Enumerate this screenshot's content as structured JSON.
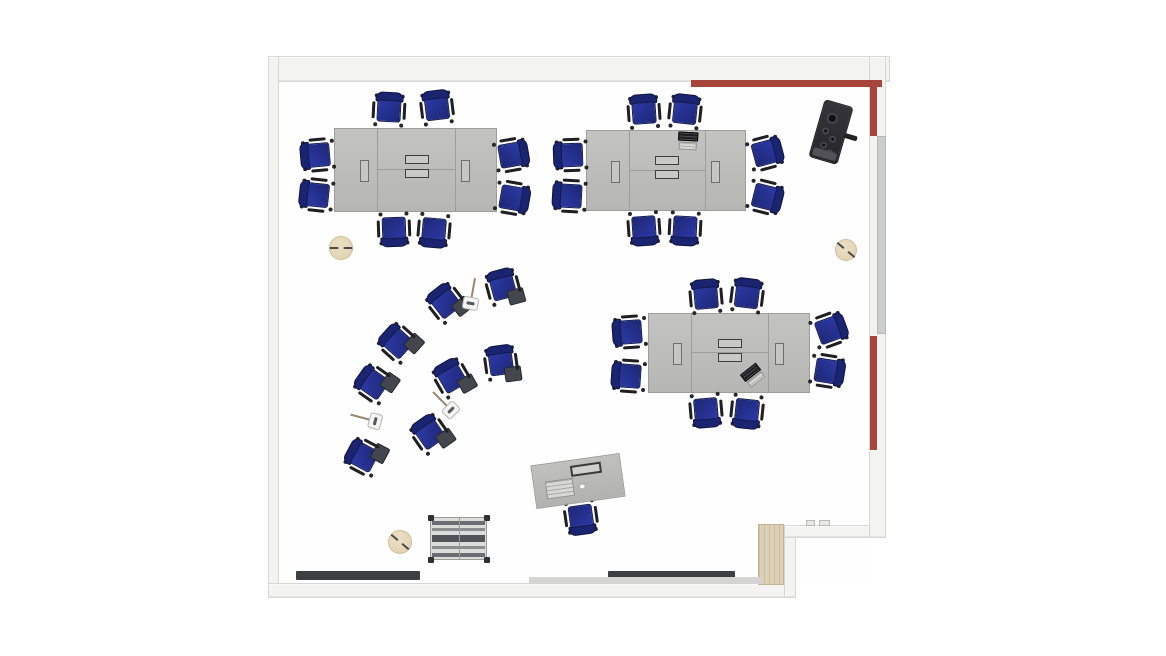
{
  "scene": {
    "kind": "classroom-floor-plan",
    "view": "top-down"
  },
  "colors": {
    "accent_red": "#a8453a",
    "table_gray": "#bcbcba",
    "chair_blue": "#232e86",
    "tablet_gray": "#43464c",
    "wall_gray": "#f3f3f2",
    "wood_tan": "#ddd0b6",
    "stool_tan": "#e6d9bc",
    "strip_dark": "#3d3f42"
  },
  "floorplan": {
    "floor": {
      "x": 279,
      "y": 78,
      "w": 590,
      "h": 507
    },
    "walls": [
      {
        "name": "wall-top",
        "x": 268,
        "y": 56,
        "w": 622,
        "h": 26
      },
      {
        "name": "wall-left",
        "x": 268,
        "y": 56,
        "w": 11,
        "h": 542
      },
      {
        "name": "wall-bottom",
        "x": 268,
        "y": 583,
        "w": 528,
        "h": 15
      },
      {
        "name": "wall-step-vertical",
        "x": 784,
        "y": 525,
        "w": 12,
        "h": 73
      },
      {
        "name": "wall-bottom-right",
        "x": 784,
        "y": 525,
        "w": 102,
        "h": 13
      },
      {
        "name": "wall-right",
        "x": 869,
        "y": 56,
        "w": 17,
        "h": 482
      }
    ],
    "red_accents": [
      {
        "name": "red-accent-wall-top",
        "x": 691,
        "y": 80,
        "w": 191,
        "h": 7
      },
      {
        "name": "red-accent-wall-right-upper",
        "x": 870,
        "y": 86,
        "w": 7,
        "h": 50
      },
      {
        "name": "red-accent-wall-right-lower",
        "x": 870,
        "y": 336,
        "w": 7,
        "h": 114
      }
    ],
    "wall_board": {
      "name": "wall-mounted-board",
      "x": 877,
      "y": 136,
      "w": 9,
      "h": 198
    },
    "door_panel": {
      "name": "door-panel",
      "x": 758,
      "y": 524,
      "w": 26,
      "h": 61
    },
    "door_handles": [
      {
        "x": 806,
        "y": 520,
        "w": 9,
        "h": 6
      },
      {
        "x": 819,
        "y": 520,
        "w": 11,
        "h": 6
      }
    ],
    "dark_strips": [
      {
        "x": 296,
        "y": 571,
        "w": 124,
        "h": 9
      },
      {
        "x": 608,
        "y": 571,
        "w": 127,
        "h": 9
      }
    ],
    "floor_ramp": {
      "x": 529,
      "y": 577,
      "w": 233,
      "h": 7
    },
    "tables": [
      {
        "x": 334,
        "y": 128,
        "w": 163,
        "h": 84
      },
      {
        "x": 586,
        "y": 130,
        "w": 160,
        "h": 81
      },
      {
        "x": 648,
        "y": 313,
        "w": 162,
        "h": 80
      }
    ],
    "task_chairs": [
      {
        "x": 389,
        "y": 110,
        "r": 3
      },
      {
        "x": 437,
        "y": 108,
        "r": -7
      },
      {
        "x": 394,
        "y": 229,
        "r": 178
      },
      {
        "x": 434,
        "y": 230,
        "r": 185
      },
      {
        "x": 318,
        "y": 155,
        "r": -95
      },
      {
        "x": 317,
        "y": 195,
        "r": -84
      },
      {
        "x": 511,
        "y": 155,
        "r": 80
      },
      {
        "x": 512,
        "y": 198,
        "r": 100
      },
      {
        "x": 644,
        "y": 112,
        "r": -4
      },
      {
        "x": 685,
        "y": 112,
        "r": 6
      },
      {
        "x": 644,
        "y": 228,
        "r": 176
      },
      {
        "x": 685,
        "y": 228,
        "r": 183
      },
      {
        "x": 571,
        "y": 155,
        "r": -92
      },
      {
        "x": 570,
        "y": 196,
        "r": -87
      },
      {
        "x": 765,
        "y": 153,
        "r": 75
      },
      {
        "x": 765,
        "y": 197,
        "r": 104
      },
      {
        "x": 706,
        "y": 297,
        "r": -5
      },
      {
        "x": 747,
        "y": 296,
        "r": 7
      },
      {
        "x": 706,
        "y": 410,
        "r": 175
      },
      {
        "x": 747,
        "y": 411,
        "r": 186
      },
      {
        "x": 630,
        "y": 332,
        "r": -94
      },
      {
        "x": 629,
        "y": 376,
        "r": -86
      },
      {
        "x": 829,
        "y": 330,
        "r": 70
      },
      {
        "x": 827,
        "y": 371,
        "r": 99
      },
      {
        "x": 581,
        "y": 517,
        "r": 172
      }
    ],
    "tablet_chairs": [
      {
        "x": 503,
        "y": 287,
        "r": -15
      },
      {
        "x": 446,
        "y": 303,
        "r": -38
      },
      {
        "x": 398,
        "y": 343,
        "r": -48
      },
      {
        "x": 501,
        "y": 363,
        "r": -8
      },
      {
        "x": 452,
        "y": 378,
        "r": -30
      },
      {
        "x": 374,
        "y": 384,
        "r": -55
      },
      {
        "x": 430,
        "y": 434,
        "r": -35
      },
      {
        "x": 364,
        "y": 457,
        "r": -62
      }
    ],
    "music_stands": [
      {
        "x": 472,
        "y": 295,
        "r": 10
      },
      {
        "x": 445,
        "y": 404,
        "r": -45
      },
      {
        "x": 367,
        "y": 419,
        "r": -75
      }
    ],
    "stools": [
      {
        "x": 341,
        "y": 248,
        "d": 24,
        "r": 0
      },
      {
        "x": 846,
        "y": 250,
        "d": 22,
        "r": 40
      },
      {
        "x": 400,
        "y": 542,
        "d": 24,
        "r": 40
      }
    ],
    "storage_cart": {
      "x": 430,
      "y": 517,
      "w": 57,
      "h": 43
    },
    "teacher_desk": {
      "x": 533,
      "y": 459,
      "w": 90,
      "h": 44,
      "r": -8
    },
    "media_cart": {
      "x": 816,
      "y": 102,
      "w": 30,
      "h": 60,
      "r": 16
    },
    "laptops": [
      {
        "x": 678,
        "y": 132,
        "w": 20,
        "h": 18,
        "r": 3
      },
      {
        "x": 743,
        "y": 367,
        "w": 20,
        "h": 17,
        "r": -38
      }
    ]
  }
}
